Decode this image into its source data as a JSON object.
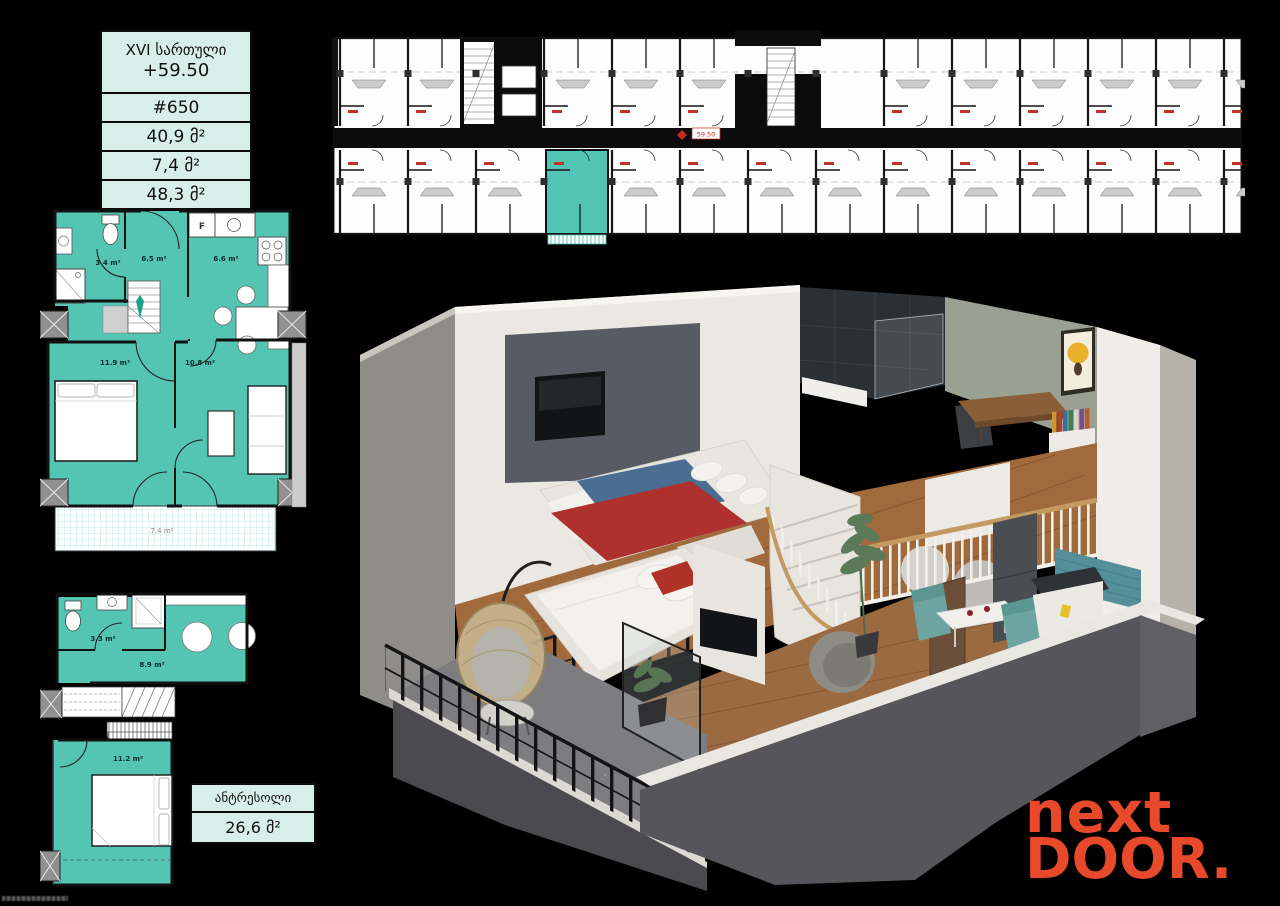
{
  "colors": {
    "accent_teal": "#54c4b3",
    "card_bg": "#d8efe9",
    "logo_orange": "#e8492a",
    "plan_wall": "#111111"
  },
  "unit_card": {
    "floor": "XVI სართული",
    "elevation": "+59.50",
    "unit_number": "#650",
    "area_apartment": "40,9 მ²",
    "area_balcony": "7,4 მ²",
    "area_total": "48,3 მ²"
  },
  "mezzanine_card": {
    "title": "ანტრესოლი",
    "area": "26,6 მ²"
  },
  "building_plan": {
    "elevation_marker": "59.50"
  },
  "main_plan": {
    "bathroom": "3.4 m²",
    "hall": "6.5 m²",
    "kitchen": "6.6 m²",
    "bedroom": "11.9 m²",
    "living_room": "10.8 m²",
    "balcony": "7.4 m²",
    "fridge": "F"
  },
  "mezzanine_plan": {
    "bathroom": "3.3 m²",
    "lounge": "8.9 m²",
    "bedroom": "11.2 m²"
  },
  "logo": {
    "line1": "next",
    "line2": "DOOR",
    "dot": "."
  }
}
